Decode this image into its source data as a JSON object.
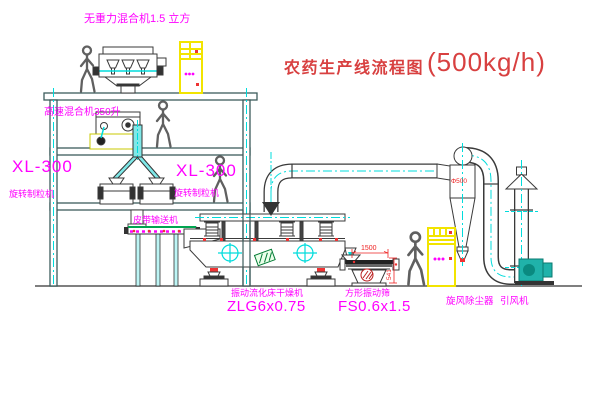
{
  "title": {
    "zh": "农药生产线流程图",
    "capacity": "(500kg/h)"
  },
  "labels": {
    "gravity_mixer": "无重力混合机1.5 立方",
    "high_speed_mixer": "高速混合机350升",
    "granulator_left_model": "XL-300",
    "granulator_left_name": "旋转制粒机",
    "granulator_mid_model": "XL-300",
    "granulator_mid_name": "旋转制粒机",
    "belt_conveyor": "皮带输送机",
    "dryer_name": "振动流化床干燥机",
    "dryer_model": "ZLG6x0.75",
    "screen_name": "方形振动筛",
    "screen_model": "FS0.6x1.5",
    "cyclone": "旋风除尘器",
    "fan": "引风机"
  },
  "dimensions": {
    "screen_length": "1500",
    "screen_height": "541",
    "cyclone_diameter": "Φ500"
  },
  "colors": {
    "label_magenta": "#ff00ff",
    "title_red": "#d84040",
    "dimension_red": "#ee2222",
    "centerline_cyan": "#00dcdc",
    "cabinet_yellow": "#f2e400",
    "structure_teal": "#3d5c5c",
    "equipment_gray": "#3a3a3a",
    "conveyor_green": "#00a550",
    "fan_teal": "#20b2aa"
  }
}
